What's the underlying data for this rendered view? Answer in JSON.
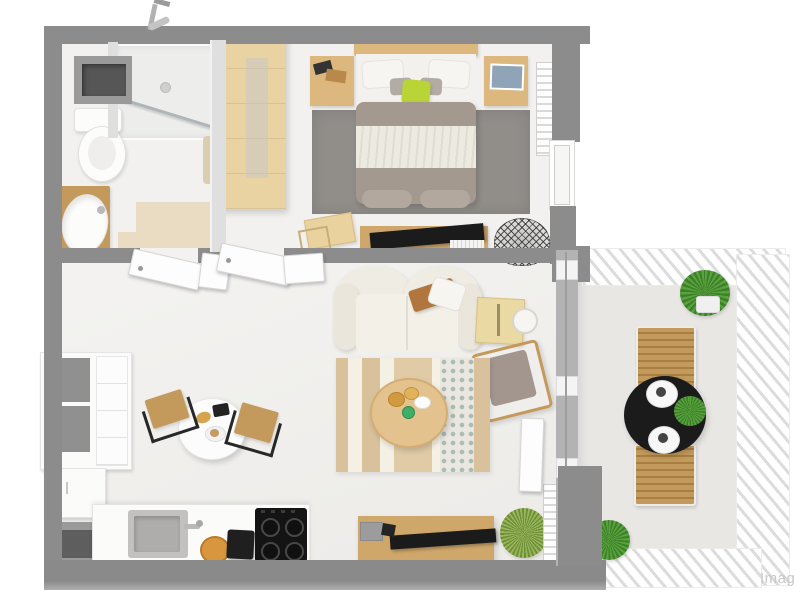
{
  "watermark": "Imag",
  "colors": {
    "bg": "#ffffff",
    "wall": "#8c8c8c",
    "wall_mid": "#a9a9a9",
    "partition": "#dfdfdf",
    "floor": "#f2f1ef",
    "floor_beige": "#e9dcc2",
    "balcony_floor": "#e8e7e4",
    "white": "#fbfbfa",
    "wood_light": "#ead3a3",
    "wood_mid": "#dcb87f",
    "wood_dark": "#c49a5c",
    "wood_console": "#cfa76b",
    "duvet": "#a4998f",
    "blanket": "#edeae2",
    "pillow_gray": "#b3aca4",
    "lime": "#b8d437",
    "rug_gray": "#918e8a",
    "rug_base": "#f0e9da",
    "rug_stripe": "#d8c19b",
    "rug_diamond": "#a9bdb4",
    "sofa": "#efece3",
    "throw": "#b0763e",
    "armchair": "#a2968e",
    "black": "#1b1b1b",
    "metal": "#b9b9b9",
    "green": "#57a33c",
    "green_dark": "#3f7f2b",
    "green_grass": "#9ab65a",
    "sink_gray": "#c2c1bf",
    "niche_dark": "#565656",
    "watermark": "#c8c8c8"
  },
  "scene": {
    "view": "3D top-down floor plan rendering of a one-bedroom apartment with balcony"
  },
  "rooms": {
    "bathroom": {
      "items": [
        "shower",
        "shower-head",
        "glass-screen",
        "toilet",
        "sink-vanity",
        "storage-niche",
        "towel",
        "bath-mat"
      ]
    },
    "bedroom": {
      "items": [
        "wardrobe",
        "double-bed",
        "lime-accent-pillow",
        "nightstand-left",
        "nightstand-right",
        "gray-area-rug",
        "desk-with-chair",
        "tv-sideboard",
        "tv",
        "wire-chair",
        "radiator",
        "window"
      ]
    },
    "living_room": {
      "items": [
        "sofa",
        "throw-blanket",
        "white-pillow",
        "side-table",
        "floor-lamp",
        "armchair",
        "striped-rug",
        "round-coffee-table",
        "tv-console",
        "tv",
        "grass-plant",
        "radiator",
        "balcony-door",
        "glass-wall"
      ]
    },
    "kitchen": {
      "items": [
        "tall-cabinet-with-open-shelves",
        "drawer-unit",
        "base-cabinet",
        "open-shelf",
        "countertop",
        "sink",
        "faucet",
        "fruit-bowl",
        "coffee-machine",
        "cooktop-4-burners",
        "round-dining-table",
        "dining-chair-left",
        "dining-chair-right"
      ]
    },
    "hallway": {
      "items": [
        "bathroom-door",
        "door-jamb",
        "bedroom-door",
        "second-door-leaf"
      ]
    },
    "balcony": {
      "items": [
        "railing-top",
        "railing-right",
        "railing-bottom",
        "lounge-chair-top",
        "lounge-chair-bottom",
        "black-bistro-table",
        "plate-setting-top",
        "plate-setting-bottom",
        "table-plant",
        "potted-plant-top",
        "potted-plant-bottom"
      ]
    }
  }
}
